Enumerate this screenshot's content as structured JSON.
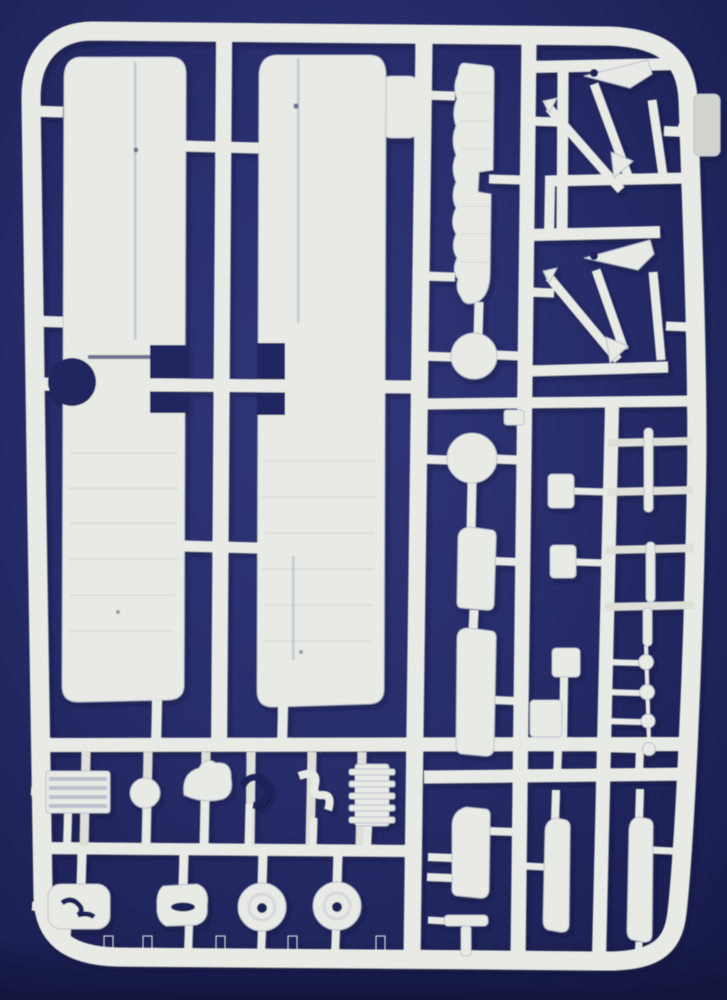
{
  "scene": {
    "kind": "photograph of an injection-molded model-kit sprue",
    "plastic_material_look": "white-grey polystyrene parts on runners",
    "background_look": "dark navy blue backdrop, darker at edges and bottom"
  },
  "colors": {
    "bg-center": "#31367a",
    "bg-mid": "#262b68",
    "bg-edge": "#1b1f52",
    "bg-deep": "#12163e",
    "navy-cut": "#232861",
    "plastic": "#e8eae5",
    "plastic-hi": "#f5f6f2",
    "plastic-mid": "#dddfd8",
    "plastic-low": "#cfd3cc",
    "plastic-shadow": "#b9bfce",
    "detail-dark": "#1f2458",
    "streak": "#d6d9d2",
    "rib-dark": "#a8aec2",
    "tab": "#d2d5cf",
    "shadow": "#0a0e2e"
  },
  "parts": [
    {
      "name": "sprue-frame",
      "label": "outer runner frame"
    },
    {
      "name": "side-tab",
      "label": "pale tab on right edge"
    },
    {
      "name": "wing-panel-left",
      "label": "large wing panel, left"
    },
    {
      "name": "wing-panel-right",
      "label": "large wing panel, right"
    },
    {
      "name": "ribbed-strip",
      "label": "long ribbed strip part"
    },
    {
      "name": "disc-small",
      "label": "small round disc"
    },
    {
      "name": "disc-large",
      "label": "large round disc"
    },
    {
      "name": "slab-upper",
      "label": "small vertical slab"
    },
    {
      "name": "slab-lower",
      "label": "long vertical slab"
    },
    {
      "name": "strut-set-top",
      "label": "diagonal strut pair with triangular fitting, upper"
    },
    {
      "name": "strut-set-bottom",
      "label": "diagonal strut pair with triangular fitting, lower"
    },
    {
      "name": "connector-rect-1",
      "label": "small rectangular fitting 1"
    },
    {
      "name": "connector-rect-2",
      "label": "small rectangular fitting 2"
    },
    {
      "name": "connector-rect-3",
      "label": "small rectangular fitting 3"
    },
    {
      "name": "connector-rect-4",
      "label": "small rectangular fitting 4"
    },
    {
      "name": "thin-strip-1",
      "label": "thin strip part 1"
    },
    {
      "name": "thin-strip-2",
      "label": "thin strip part 2"
    },
    {
      "name": "thin-strip-3",
      "label": "thin strip part 3"
    },
    {
      "name": "bead-chain",
      "label": "row of four small round beads"
    },
    {
      "name": "radiator-block",
      "label": "ribbed radiator block"
    },
    {
      "name": "ball-part",
      "label": "small ball"
    },
    {
      "name": "dome-part",
      "label": "rounded dome blob"
    },
    {
      "name": "ring-part",
      "label": "open ring / crescent"
    },
    {
      "name": "s-part",
      "label": "S-curved fitting"
    },
    {
      "name": "cylinder-block",
      "label": "finned cylinder block"
    },
    {
      "name": "pan-part",
      "label": "rounded pan with curled detail"
    },
    {
      "name": "slotted-part",
      "label": "oval part with slot"
    },
    {
      "name": "wheel-left",
      "label": "wheel with hub hole, left"
    },
    {
      "name": "wheel-right",
      "label": "wheel with hub hole, right"
    },
    {
      "name": "blade-slab-1",
      "label": "vertical blade slab 1"
    },
    {
      "name": "blade-slab-2",
      "label": "vertical blade slab 2"
    },
    {
      "name": "blade-slab-3",
      "label": "vertical blade slab 3"
    },
    {
      "name": "tee-part",
      "label": "small T-shaped part"
    },
    {
      "name": "clip-part",
      "label": "tiny clip block"
    }
  ]
}
